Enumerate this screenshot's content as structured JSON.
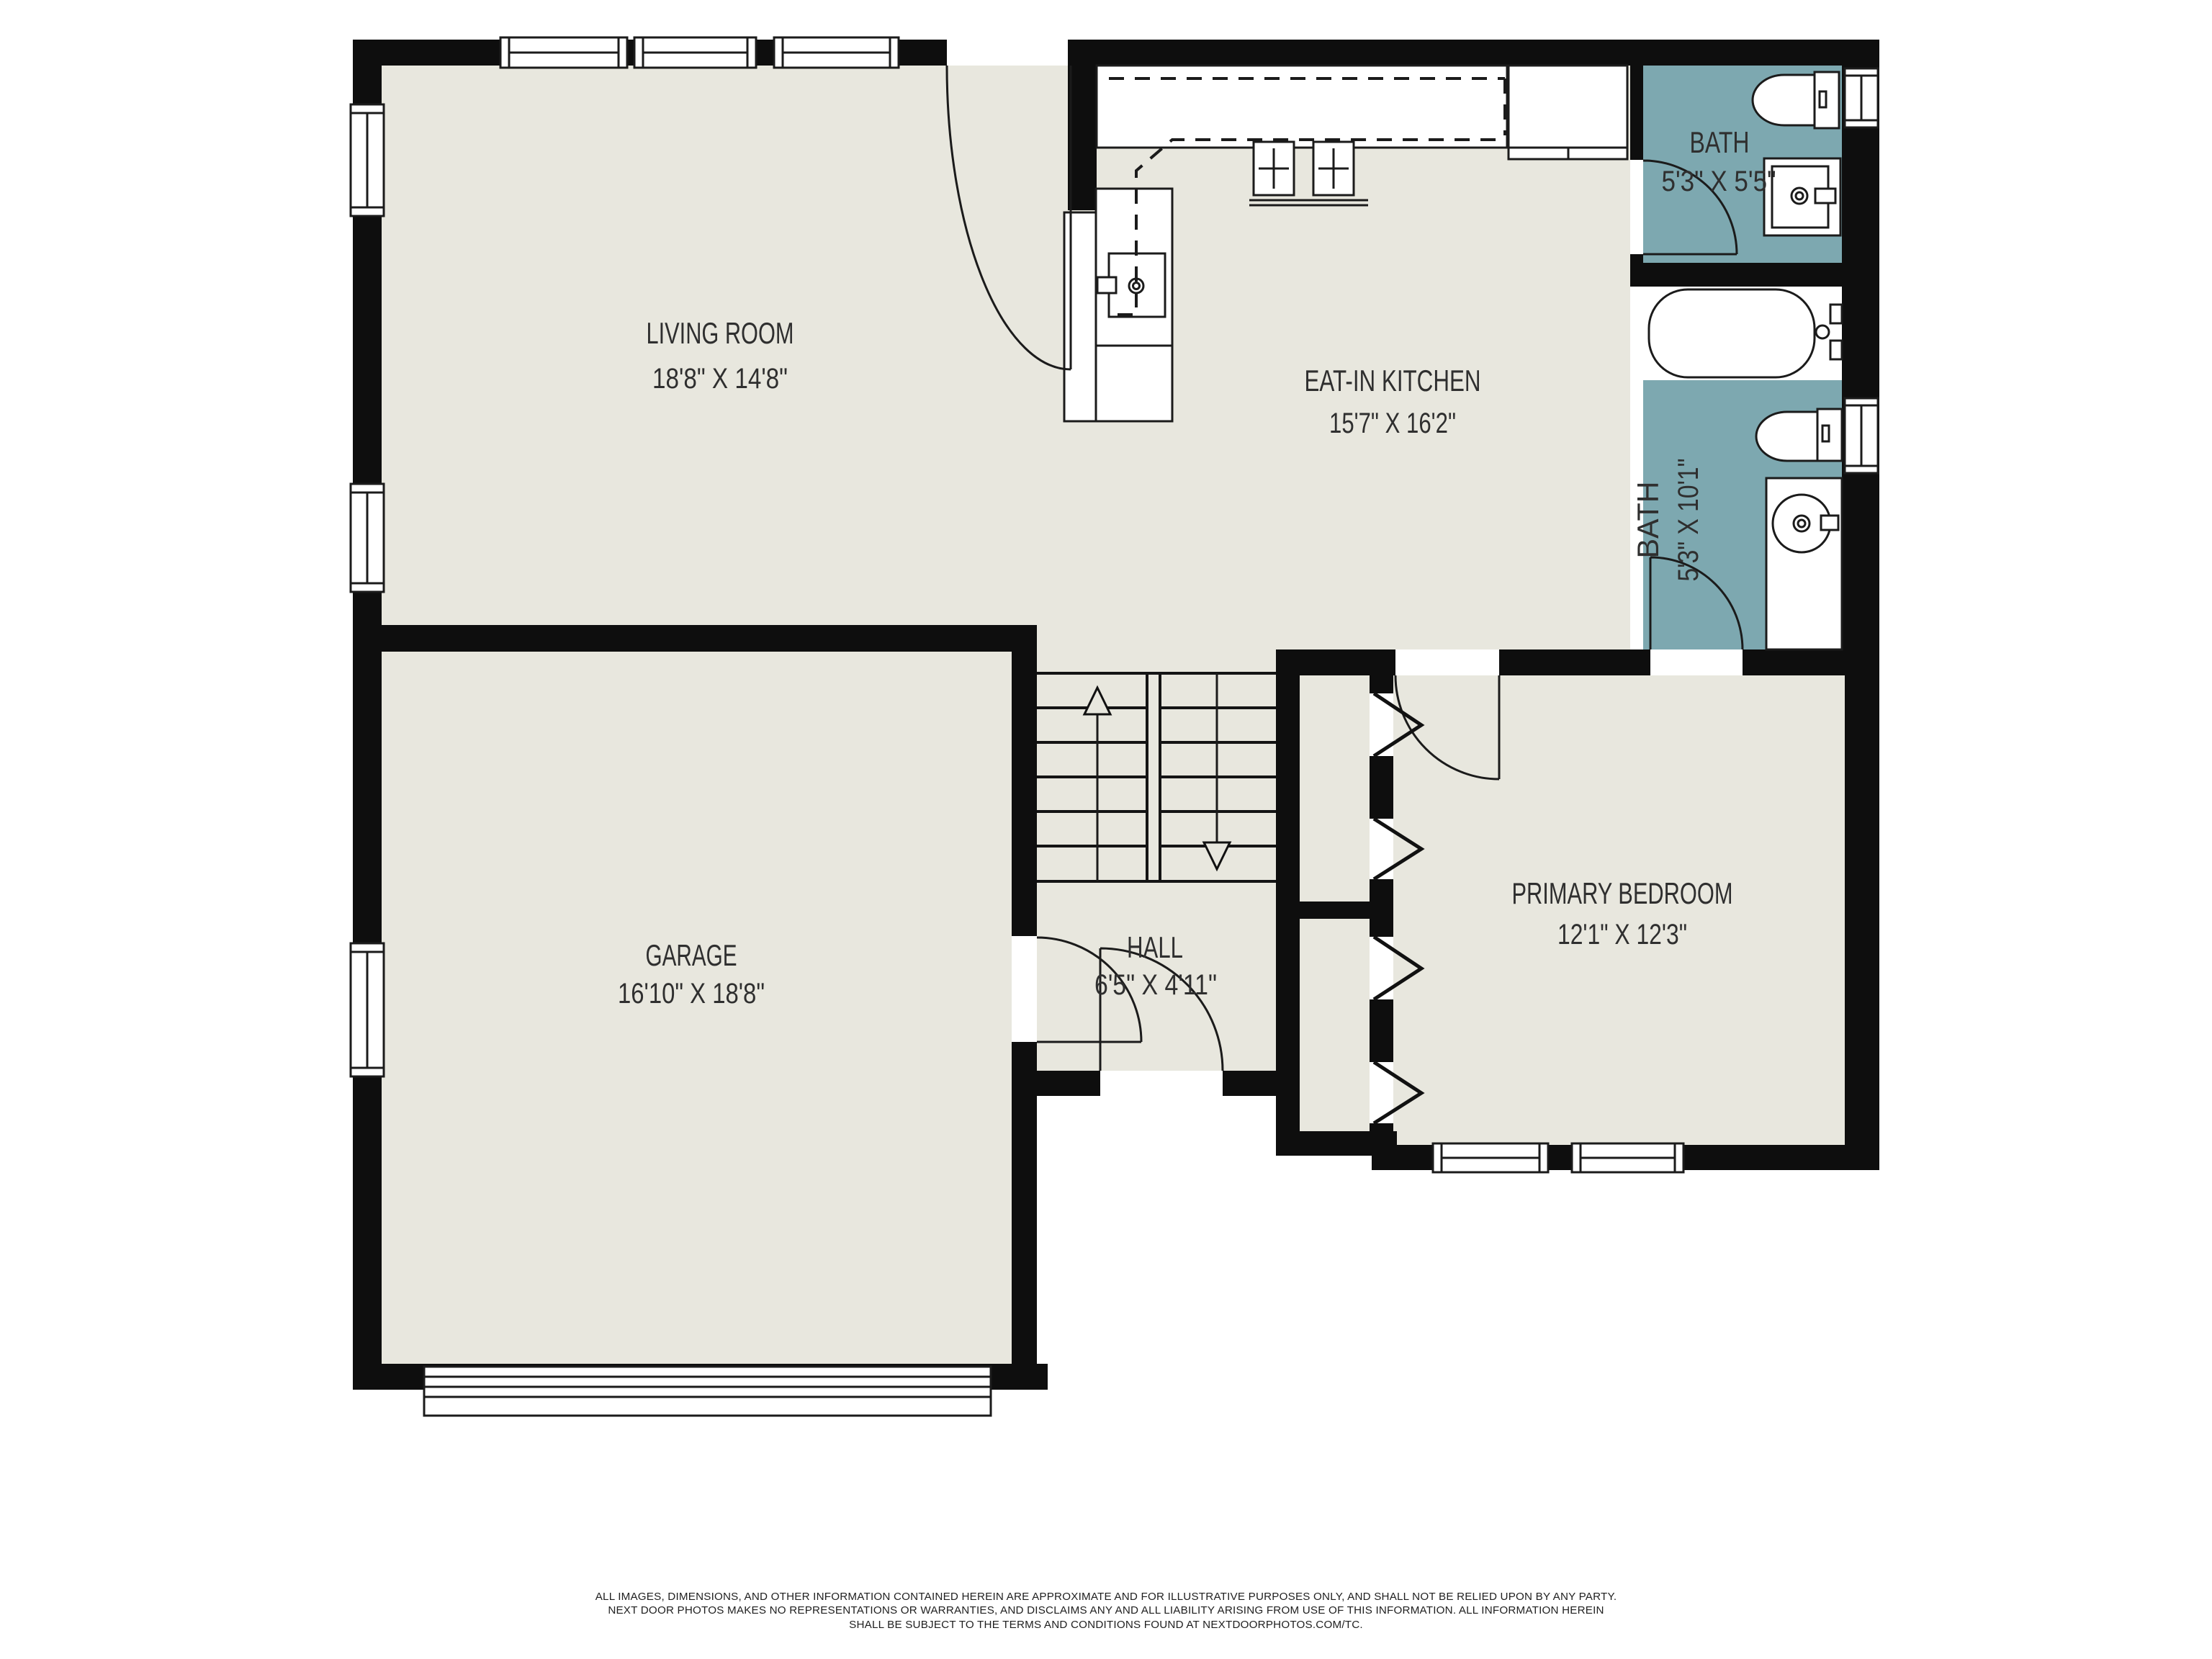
{
  "title": "Floor plan",
  "colors": {
    "floor": "#e8e7de",
    "bath_floor": "#7da8b0",
    "wall": "#0e0e0e",
    "line": "#1b1b1b",
    "label_text": "#2f2f2f"
  },
  "rooms": {
    "living": {
      "name": "LIVING ROOM",
      "dims": "18'8\" X 14'8\""
    },
    "kitchen": {
      "name": "EAT-IN KITCHEN",
      "dims": "15'7\" X 16'2\""
    },
    "bath1": {
      "name": "BATH",
      "dims": "5'3\" X 5'5\""
    },
    "bath2": {
      "name": "BATH",
      "dims": "5'3\" X 10'1\""
    },
    "garage": {
      "name": "GARAGE",
      "dims": "16'10\" X 18'8\""
    },
    "hall": {
      "name": "HALL",
      "dims": "6'5\" X 4'11\""
    },
    "bedroom": {
      "name": "PRIMARY BEDROOM",
      "dims": "12'1\" X 12'3\""
    }
  },
  "fixture_icons": [
    "toilet-icon",
    "sink-icon",
    "bathtub-icon",
    "stove-icon",
    "refrigerator-icon",
    "kitchen-sink-icon",
    "stairs-up-arrow-icon",
    "stairs-down-arrow-icon",
    "door-arc-icon",
    "window-icon",
    "garage-door-icon",
    "closet-bifold-icon"
  ],
  "disclaimer": {
    "lines": [
      "ALL IMAGES, DIMENSIONS, AND OTHER INFORMATION CONTAINED HEREIN ARE APPROXIMATE AND FOR ILLUSTRATIVE PURPOSES ONLY, AND SHALL NOT BE RELIED UPON BY ANY PARTY.",
      "NEXT DOOR PHOTOS MAKES NO REPRESENTATIONS OR WARRANTIES, AND DISCLAIMS ANY AND ALL LIABILITY ARISING FROM USE OF THIS INFORMATION. ALL INFORMATION HEREIN",
      "SHALL BE SUBJECT TO THE TERMS AND CONDITIONS FOUND AT NEXTDOORPHOTOS.COM/TC."
    ]
  }
}
